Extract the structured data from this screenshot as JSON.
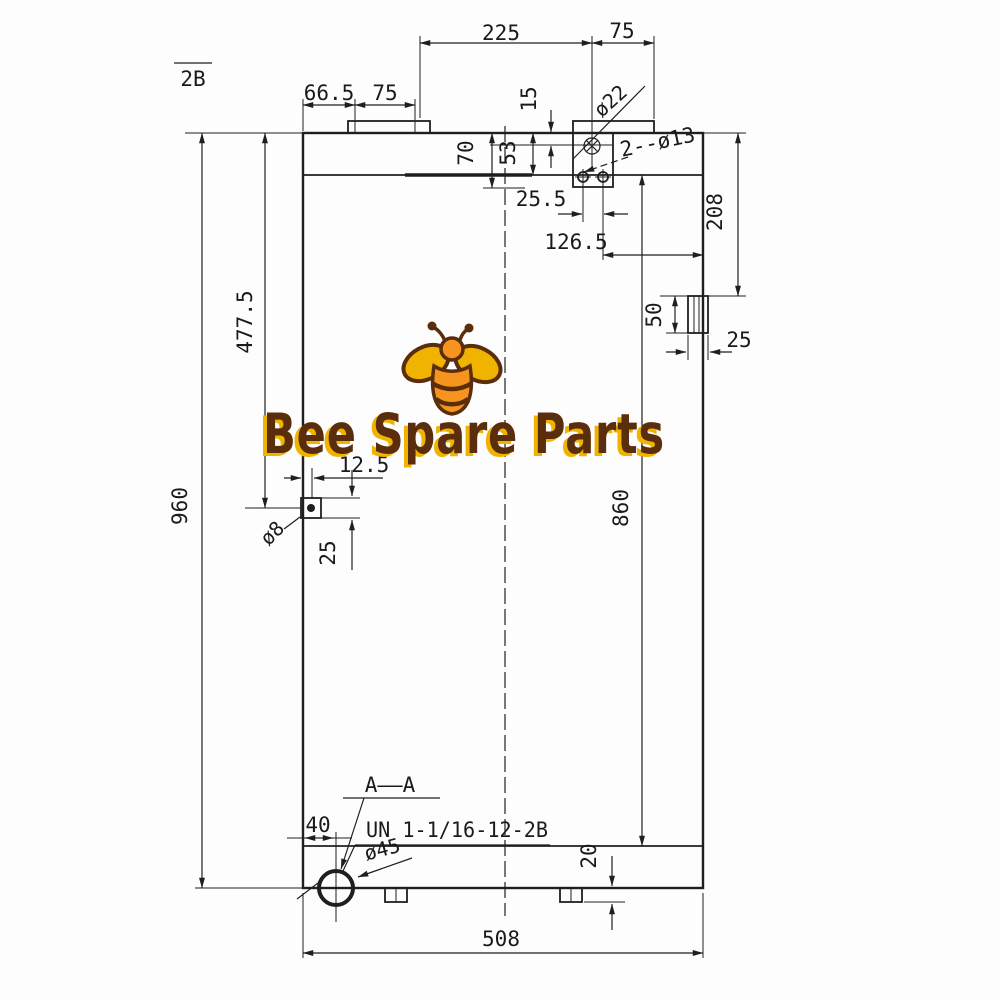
{
  "drawing": {
    "thread_class_note": "2B",
    "dims": {
      "cap_offset": "66.5",
      "cap_width": "75",
      "port_span": "225",
      "port_to_edge": "75",
      "port_depth": "15",
      "tank_depth": "53",
      "bracket_depth": "70",
      "hole_spacing": "25.5",
      "hole_to_edge": "126.5",
      "bracket_height": "208",
      "side_port_height": "50",
      "side_port_width": "25",
      "total_height": "960",
      "drain_height": "477.5",
      "drain_offset": "12.5",
      "drain_block": "25",
      "core_height": "860",
      "outlet_offset": "40",
      "foot_height": "20",
      "total_width": "508"
    },
    "callouts": {
      "inlet_port": "ø22",
      "bolt_holes": "2--ø13",
      "drain_port": "ø8",
      "outlet_port": "ø45",
      "section_label": "A——A",
      "thread_spec": "UN 1-1/16-12-2B"
    }
  },
  "logo": {
    "text": "Bee Spare Parts"
  },
  "colors": {
    "line": "#1f1f1f",
    "background": "#fdfdfd",
    "logo_gold": "#F0B400",
    "logo_orange": "#F7941D",
    "logo_brown": "#5A2D0C"
  }
}
